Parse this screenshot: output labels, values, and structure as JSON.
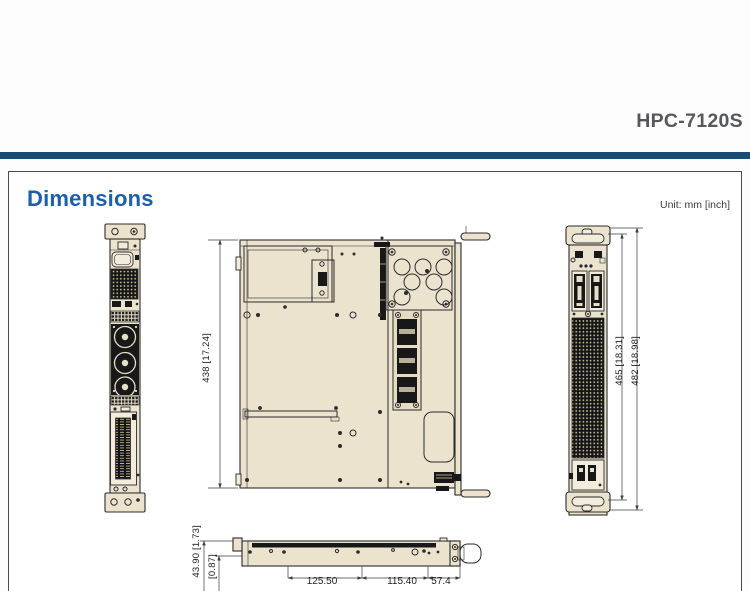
{
  "header": {
    "model": "HPC-7120S"
  },
  "section": {
    "title": "Dimensions",
    "unit_note": "Unit: mm [inch]"
  },
  "dimensions": {
    "depth": "438 [17.24]",
    "height_inner": "465 [18.31]",
    "height_overall": "482 [18.98]",
    "side_height": "43.90 [1.73]",
    "side_offset": "[0.87]",
    "widths": [
      "125.50",
      "115.40",
      "57.4"
    ]
  },
  "colors": {
    "accent_blue": "#1d5fa8",
    "rule_navy": "#1b4a72",
    "drawing_fill": "#ece3cf",
    "line": "#2b2b2b",
    "title_gray": "#57585a"
  }
}
